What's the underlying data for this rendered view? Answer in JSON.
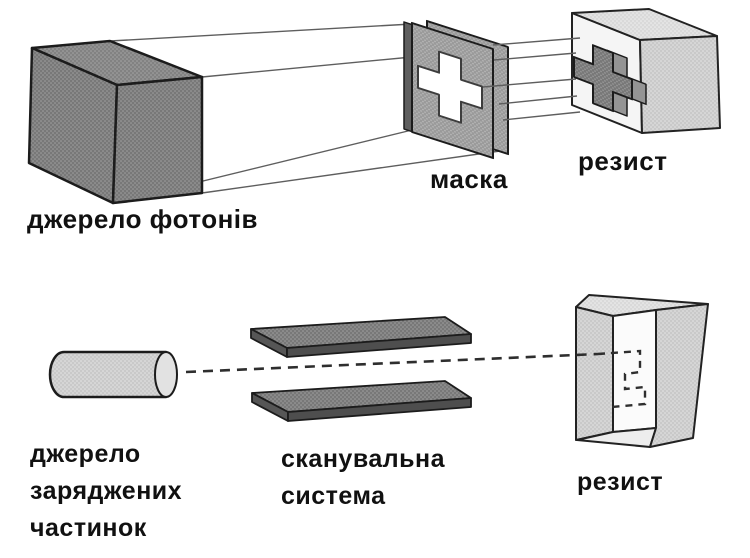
{
  "top_diagram": {
    "source_label": "джерело фотонів",
    "mask_label": "маска",
    "resist_label": "резист"
  },
  "bottom_diagram": {
    "source_label_lines": [
      "джерело",
      "заряджених",
      "частинок"
    ],
    "scanner_label_lines": [
      "сканувальна",
      "система"
    ],
    "resist_label": "резист"
  },
  "palette": {
    "dark_gray": "#787878",
    "mid_gray": "#9a9a9a",
    "light_gray": "#c9c9c9",
    "pale_gray": "#d9d9d9",
    "aperture_white": "#ffffff",
    "outline": "#1c1c1c",
    "label_color": "#111111",
    "background": "#ffffff"
  }
}
